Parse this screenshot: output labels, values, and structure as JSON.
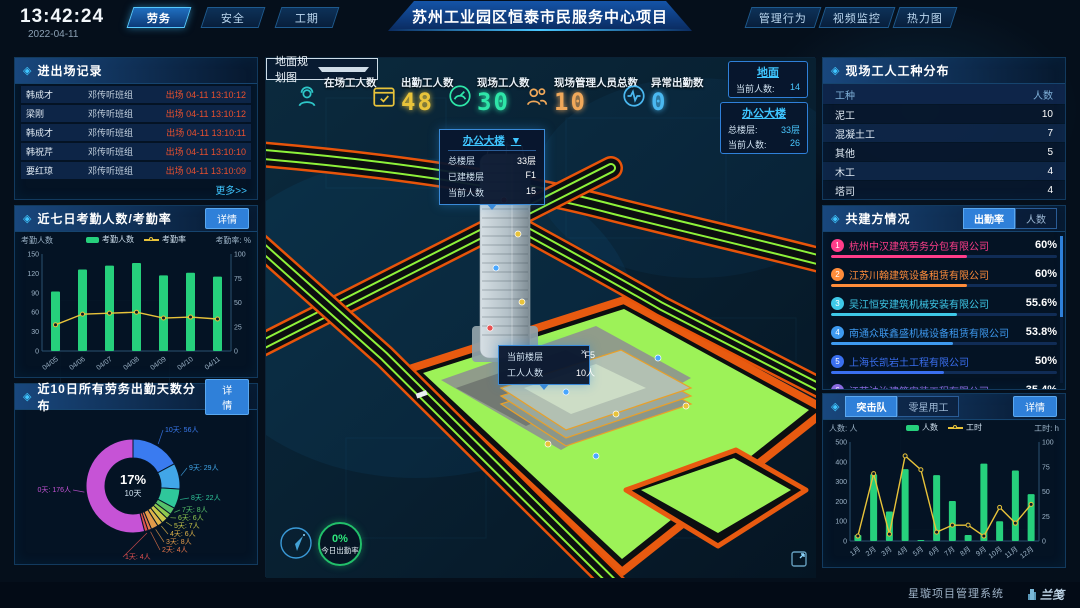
{
  "topbar": {
    "time": "13:42:24",
    "date": "2022-04-11",
    "tabs_left": [
      {
        "label": "劳务",
        "active": true
      },
      {
        "label": "安全",
        "active": false
      },
      {
        "label": "工期",
        "active": false
      }
    ],
    "title": "苏州工业园区恒泰市民服务中心项目",
    "tabs_right": [
      {
        "label": "管理行为"
      },
      {
        "label": "视频监控"
      },
      {
        "label": "热力图"
      }
    ]
  },
  "colors": {
    "accent": "#3fc6ff",
    "exit_red": "#e8502e",
    "bar_green": "#26d07c",
    "line_yellow": "#e8c33a",
    "panel_border": "#123a5e"
  },
  "entry_exit": {
    "title": "进出场记录",
    "more_label": "更多>>",
    "rows": [
      {
        "name": "韩成才",
        "group": "邓传听班组",
        "event": "出场 04-11 13:10:12"
      },
      {
        "name": "梁刚",
        "group": "邓传听班组",
        "event": "出场 04-11 13:10:12"
      },
      {
        "name": "韩成才",
        "group": "邓传听班组",
        "event": "出场 04-11 13:10:11"
      },
      {
        "name": "韩祝芹",
        "group": "邓传听班组",
        "event": "出场 04-11 13:10:10"
      },
      {
        "name": "要红琼",
        "group": "邓传听班组",
        "event": "出场 04-11 13:10:09"
      }
    ]
  },
  "attendance7": {
    "title": "近七日考勤人数/考勤率",
    "detail_label": "详情",
    "left_axis_label": "考勤人数",
    "right_axis_label": "考勤率: %",
    "legend": [
      "考勤人数",
      "考勤率"
    ]
  },
  "distribution10": {
    "title": "近10日所有劳务出勤天数分布",
    "detail_label": "详情",
    "center_value": "17%",
    "center_label": "10天"
  },
  "map": {
    "layer_select": "地面规划图",
    "stats": [
      {
        "label": "在场工人数",
        "value": "",
        "color": "#2ec7c9",
        "icon": "worker-icon"
      },
      {
        "label": "出勤工人数",
        "value": "48",
        "color": "#e8c33a",
        "icon": "calendar-check-icon"
      },
      {
        "label": "现场工人数",
        "value": "30",
        "color": "#2ee6a8",
        "icon": "gauge-icon"
      },
      {
        "label": "现场管理人员总数",
        "value": "10",
        "color": "#f0a85a",
        "icon": "people-icon"
      },
      {
        "label": "异常出勤数",
        "value": "0",
        "color": "#4ab8f0",
        "icon": "pulse-icon"
      }
    ],
    "ground_badge": {
      "title": "地面",
      "rows": [
        {
          "label": "当前人数:",
          "value": "14"
        }
      ]
    },
    "building_badge": {
      "title": "办公大楼",
      "rows": [
        {
          "label": "总楼层:",
          "value": "33层"
        },
        {
          "label": "当前人数:",
          "value": "26"
        }
      ]
    },
    "building_popup": {
      "title": "办公大楼",
      "caret": "▼",
      "rows": [
        {
          "label": "总楼层",
          "value": "33层"
        },
        {
          "label": "已建楼层",
          "value": "F1"
        },
        {
          "label": "当前人数",
          "value": "15"
        }
      ]
    },
    "floor_tooltip": {
      "close": "×",
      "rows": [
        {
          "label": "当前楼层",
          "value": "F5"
        },
        {
          "label": "工人人数",
          "value": "10人"
        }
      ]
    },
    "gauge": {
      "value": "0%",
      "label": "今日出勤率"
    }
  },
  "worker_types": {
    "title": "现场工人工种分布",
    "headers": [
      "工种",
      "人数"
    ],
    "rows": [
      [
        "泥工",
        "10"
      ],
      [
        "混凝土工",
        "7"
      ],
      [
        "其他",
        "5"
      ],
      [
        "木工",
        "4"
      ],
      [
        "塔司",
        "4"
      ]
    ]
  },
  "companies": {
    "title": "共建方情况",
    "tabs": [
      {
        "label": "出勤率",
        "active": true
      },
      {
        "label": "人数",
        "active": false
      }
    ],
    "list": [
      {
        "rank": "1",
        "name": "杭州中汉建筑劳务分包有限公司",
        "value": "60%",
        "pct": 60,
        "color": "#ff3d8a"
      },
      {
        "rank": "2",
        "name": "江苏川翰建筑设备租赁有限公司",
        "value": "60%",
        "pct": 60,
        "color": "#ff8c3a"
      },
      {
        "rank": "3",
        "name": "吴江恒安建筑机械安装有限公司",
        "value": "55.6%",
        "pct": 55.6,
        "color": "#3ec8e8"
      },
      {
        "rank": "4",
        "name": "南通众联鑫盛机械设备租赁有限公司",
        "value": "53.8%",
        "pct": 53.8,
        "color": "#3e9af0"
      },
      {
        "rank": "5",
        "name": "上海长凯岩土工程有限公司",
        "value": "50%",
        "pct": 50,
        "color": "#3a6ff0"
      },
      {
        "rank": "6",
        "name": "江苏法诒建筑安装工程有限公司",
        "value": "35.4%",
        "pct": 35.4,
        "color": "#8a6ae0"
      }
    ]
  },
  "assault_team": {
    "tabs": [
      {
        "label": "突击队",
        "active": true
      },
      {
        "label": "零星用工",
        "active": false
      }
    ],
    "detail_label": "详情",
    "left_axis_label": "人数: 人",
    "right_axis_label": "工时: h",
    "legend": [
      "人数",
      "工时"
    ]
  },
  "footer": {
    "brand": "星璇项目管理系统",
    "logo": "兰笺"
  },
  "chart_data": [
    {
      "id": "attendance7",
      "type": "bar+line",
      "title": "近七日考勤人数/考勤率",
      "categories": [
        "04/05",
        "04/06",
        "04/07",
        "04/08",
        "04/09",
        "04/10",
        "04/11"
      ],
      "series": [
        {
          "name": "考勤人数",
          "type": "bar",
          "axis": "left",
          "values": [
            92,
            126,
            132,
            136,
            117,
            121,
            115
          ],
          "color": "#26d07c"
        },
        {
          "name": "考勤率",
          "type": "line",
          "axis": "right",
          "values": [
            27,
            38,
            39,
            40,
            34,
            35,
            33
          ],
          "color": "#e8c33a"
        }
      ],
      "left_axis": {
        "label": "考勤人数",
        "ticks": [
          0,
          30,
          60,
          90,
          120,
          150
        ],
        "max": 150
      },
      "right_axis": {
        "label": "考勤率: %",
        "ticks": [
          0,
          25,
          50,
          75,
          100
        ],
        "max": 100
      },
      "legend_position": "top",
      "grid": false
    },
    {
      "id": "distribution10",
      "type": "pie",
      "title": "近10日所有劳务出勤天数分布",
      "donut": true,
      "center": {
        "value": "17%",
        "label": "10天"
      },
      "unit": "人",
      "slices": [
        {
          "label": "10天",
          "count": 56,
          "color": "#3a7bf0"
        },
        {
          "label": "9天",
          "count": 29,
          "color": "#41a6e8"
        },
        {
          "label": "8天",
          "count": 22,
          "color": "#2fc79b"
        },
        {
          "label": "7天",
          "count": 8,
          "color": "#56c16a"
        },
        {
          "label": "6天",
          "count": 6,
          "color": "#8fc94f"
        },
        {
          "label": "5天",
          "count": 7,
          "color": "#c9c84a"
        },
        {
          "label": "4天",
          "count": 6,
          "color": "#e0b44a"
        },
        {
          "label": "3天",
          "count": 8,
          "color": "#e09a4a"
        },
        {
          "label": "2天",
          "count": 4,
          "color": "#e8764a"
        },
        {
          "label": "1天",
          "count": 4,
          "color": "#e05050"
        },
        {
          "label": "0天",
          "count": 176,
          "color": "#c653d6"
        }
      ]
    },
    {
      "id": "assault",
      "type": "bar+line",
      "title": "突击队",
      "categories": [
        "1月",
        "2月",
        "3月",
        "4月",
        "5月",
        "6月",
        "7月",
        "8月",
        "9月",
        "10月",
        "11月",
        "12月"
      ],
      "series": [
        {
          "name": "人数",
          "type": "bar",
          "axis": "left",
          "values": [
            30,
            337,
            149,
            363,
            4,
            333,
            202,
            30,
            391,
            100,
            356,
            237
          ],
          "color": "#26d07c"
        },
        {
          "name": "工时",
          "type": "line",
          "axis": "right",
          "values": [
            5,
            68,
            7,
            86,
            72,
            9,
            16,
            16,
            5,
            34,
            18,
            37
          ],
          "color": "#e8c33a"
        }
      ],
      "left_axis": {
        "label": "人数: 人",
        "ticks": [
          0,
          100,
          200,
          300,
          400,
          500
        ],
        "max": 500
      },
      "right_axis": {
        "label": "工时: h",
        "ticks": [
          0,
          25,
          50,
          75,
          100
        ],
        "max": 100
      },
      "legend_position": "top",
      "grid": false
    }
  ]
}
